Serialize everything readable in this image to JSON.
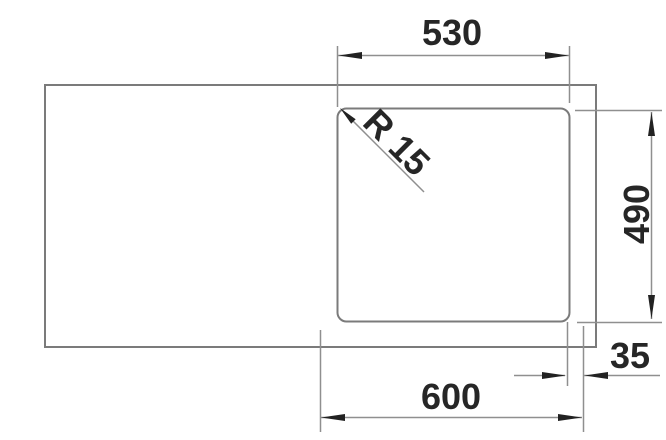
{
  "drawing": {
    "type": "technical-dimension-drawing",
    "subject": "sink cutout top view",
    "background_color": "#ffffff",
    "object_line_color": "#7b7b7b",
    "dimension_line_color": "#8f8f8f",
    "text_color": "#262626",
    "arrow_color": "#222222",
    "dimensions": {
      "bowl_width_top": "530",
      "bowl_depth_right": "490",
      "overall_width_bottom": "600",
      "edge_offset_bottom_right": "35",
      "corner_radius": "R 15"
    }
  }
}
